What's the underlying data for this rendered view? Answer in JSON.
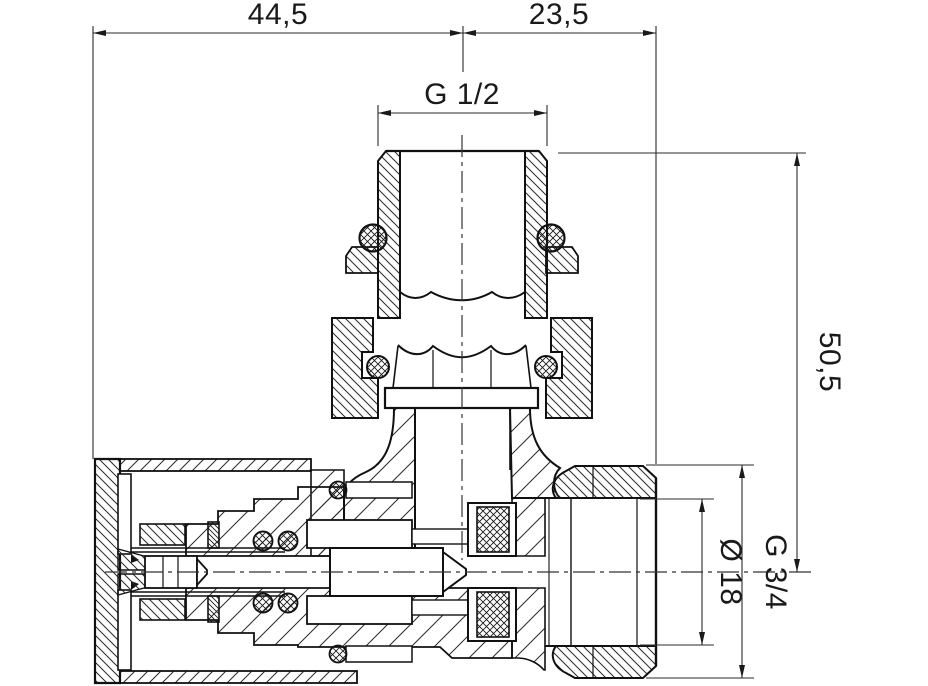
{
  "drawing": {
    "title": "valve-cross-section",
    "type": "technical-drawing",
    "dimensions": {
      "width_left": "44,5",
      "width_right": "23,5",
      "thread_top": "G 1/2",
      "height_right": "50,5",
      "bore_diameter": "Ø 18",
      "thread_right": "G 3/4"
    },
    "colors": {
      "line": "#1a1a1a",
      "dim_line": "#2b2b2b",
      "background": "#ffffff"
    }
  }
}
